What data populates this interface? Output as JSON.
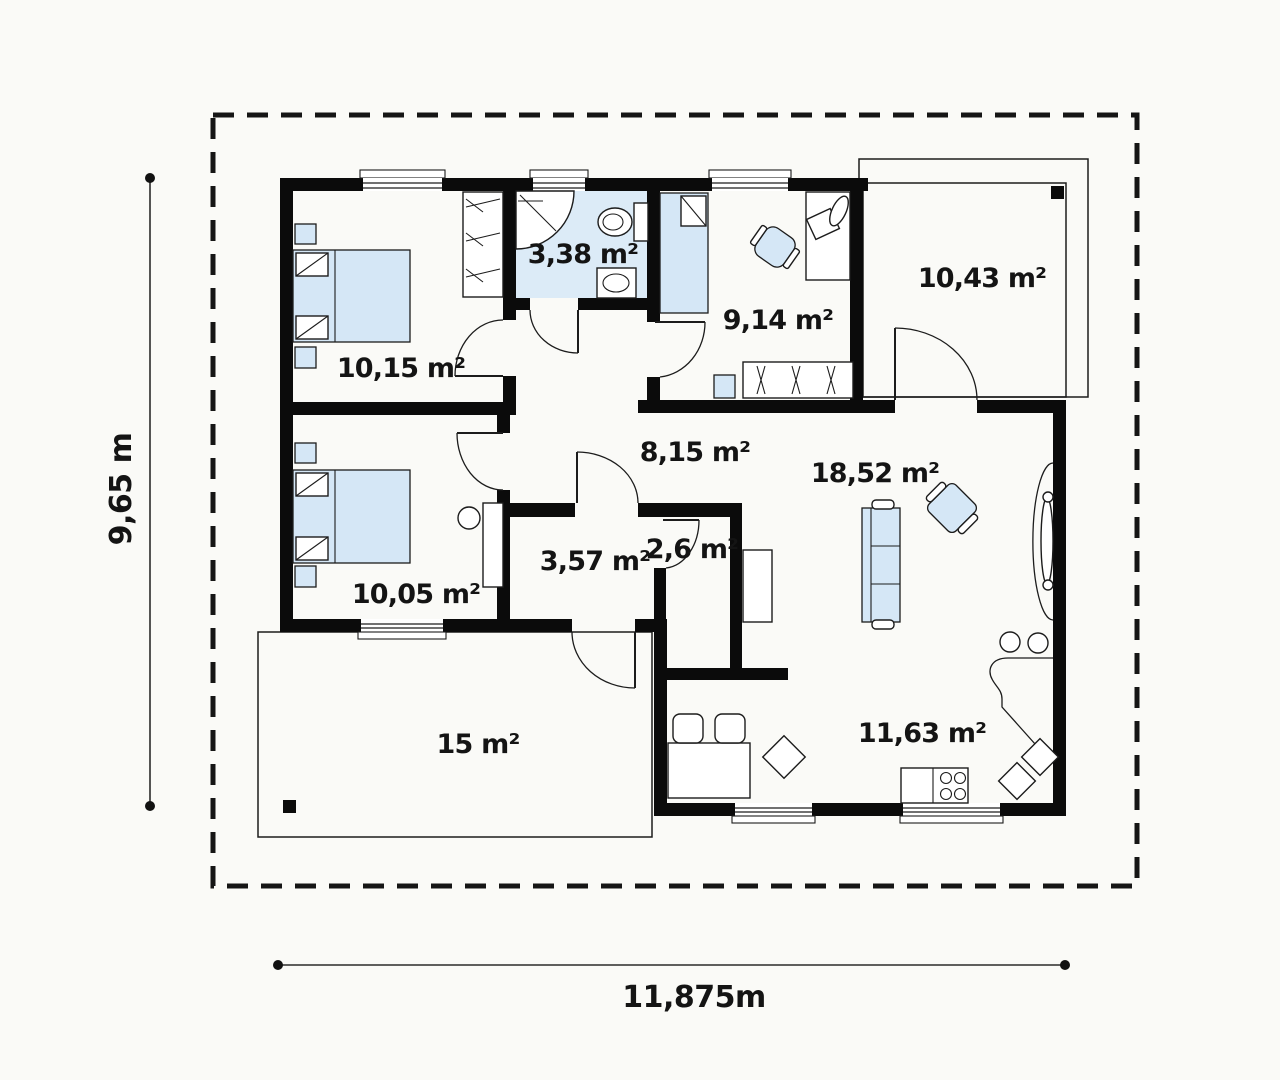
{
  "title": "Single-storey house floor plan",
  "colors": {
    "wall": "#0b0b0b",
    "line": "#1c1c1c",
    "furniture_fill": "#d5e7f6",
    "bathroom_floor": "#dcebf7",
    "background": "#fafaf7",
    "text": "#141414",
    "dimension": "#2a2a2a"
  },
  "rooms": [
    {
      "id": "bedroom-1",
      "label": "10,15 m²"
    },
    {
      "id": "bathroom",
      "label": "3,38 m²"
    },
    {
      "id": "bedroom-2",
      "label": "9,14 m²"
    },
    {
      "id": "covered-terrace",
      "label": "10,43 m²"
    },
    {
      "id": "hallway",
      "label": "8,15 m²"
    },
    {
      "id": "living-room",
      "label": "18,52 m²"
    },
    {
      "id": "bedroom-3",
      "label": "10,05 m²"
    },
    {
      "id": "hall",
      "label": "3,57 m²"
    },
    {
      "id": "closet",
      "label": "2,6 m²"
    },
    {
      "id": "terrace",
      "label": "15 m²"
    },
    {
      "id": "kitchen",
      "label": "11,63 m²"
    }
  ],
  "dimensions": {
    "height_label": "9,65 m",
    "width_label": "11,875m"
  }
}
